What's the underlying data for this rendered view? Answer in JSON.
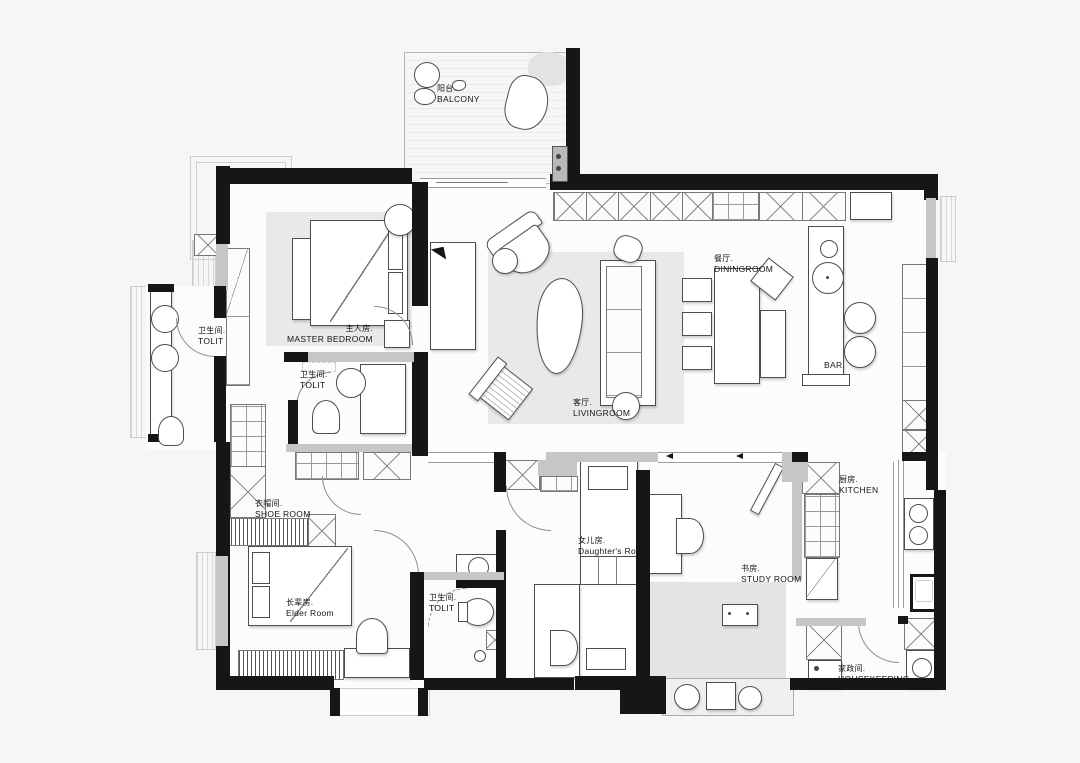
{
  "rooms": {
    "balcony": {
      "zh": "阳台.",
      "en": "BALCONY"
    },
    "master_bedroom": {
      "zh": "主人房.",
      "en": "MASTER BEDROOM"
    },
    "toilet_left": {
      "zh": "卫生间.",
      "en": "TOLIT"
    },
    "toilet_master": {
      "zh": "卫生间.",
      "en": "TOLIT"
    },
    "toilet_middle": {
      "zh": "卫生间.",
      "en": "TOLIT"
    },
    "livingroom": {
      "zh": "客厅.",
      "en": "LIVINGROOM"
    },
    "diningroom": {
      "zh": "餐厅.",
      "en": "DININGROOM"
    },
    "bar": {
      "en": "BAR."
    },
    "kitchen": {
      "zh": "厨房.",
      "en": "KITCHEN"
    },
    "shoe_room": {
      "zh": "衣帽间.",
      "en": "SHOE ROOM"
    },
    "elder_room": {
      "zh": "长辈房.",
      "en": "Elder Room"
    },
    "daughters_room": {
      "zh": "女儿房.",
      "en": "Daughter's Room"
    },
    "study_room": {
      "zh": "书房.",
      "en": "STUDY ROOM"
    },
    "housekeeping": {
      "zh": "家政间.",
      "en": "HOUSEKEEPING"
    }
  },
  "colors": {
    "wall": "#161616",
    "wall_light": "#c6c6c6",
    "floor": "#fcfcfc",
    "rug": "#e9e9e9",
    "background": "#f6f6f6"
  }
}
